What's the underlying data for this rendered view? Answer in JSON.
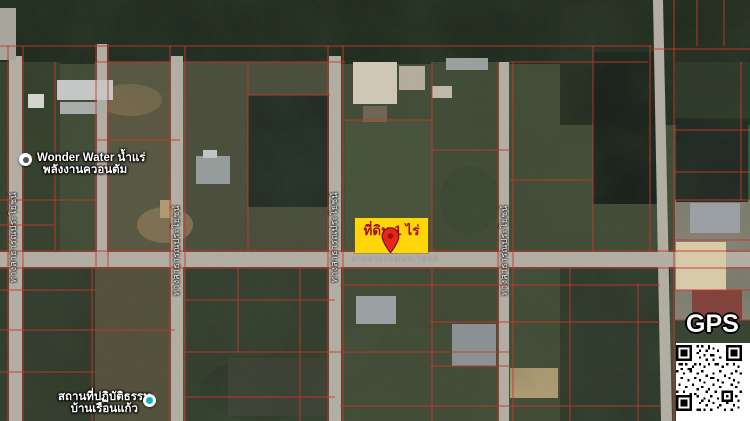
{
  "map": {
    "parcel_highlight": {
      "label": "ที่ดิน 1 ไร่"
    },
    "road_name": "ทางสาธารณประโยชน์",
    "vertical_road_labels": [
      "ทางสาธารณประโยชน์",
      "ทางสาธารณประโยชน์",
      "ทางสาธารณประโยชน์",
      "ทางสาธารณประโยชน์"
    ],
    "pois": [
      {
        "line1": "Wonder Water น้ำแร่",
        "line2": "พลังงานควอนตัม"
      },
      {
        "line1": "สถานที่ปฏิบัติธรรม",
        "line2": "บ้านเรือนแก้ว"
      }
    ],
    "gps_label": "GPS"
  },
  "colors": {
    "parcel_line": "#c7372b",
    "highlight_bg": "#ffd60a",
    "highlight_text": "#a50d06",
    "pin_red": "#e8251a",
    "poi_teal": "#0fb3c7",
    "road": "#b2aea4"
  }
}
